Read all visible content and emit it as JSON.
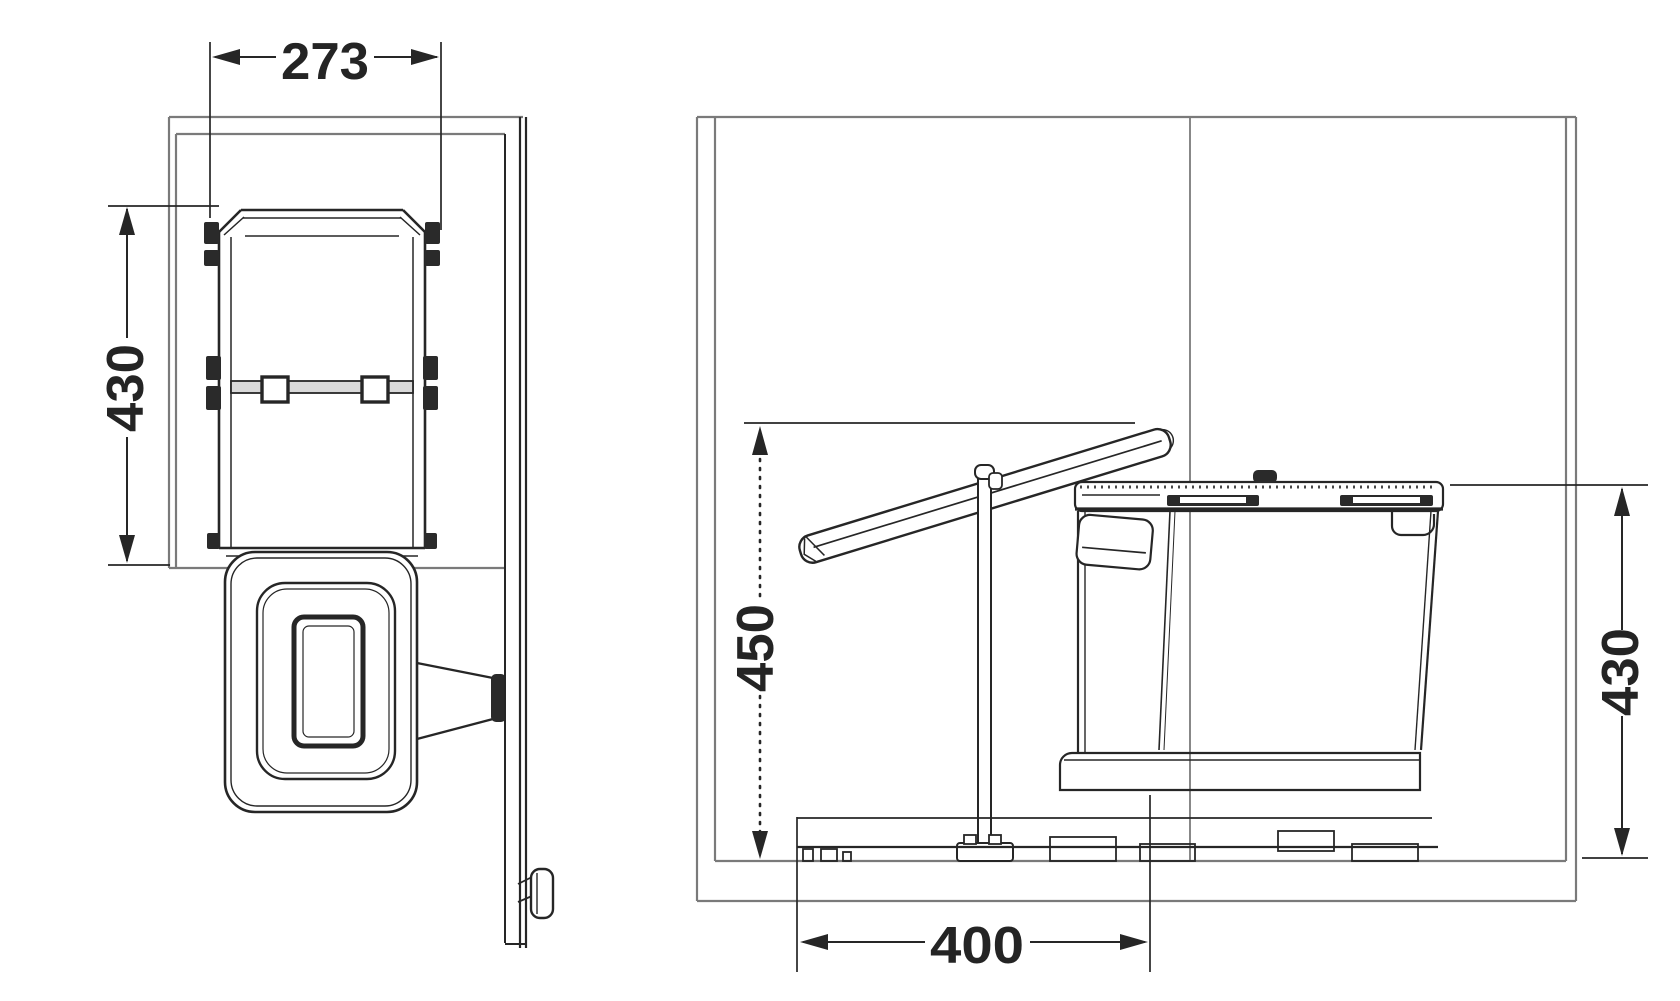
{
  "drawing_type": "installation-dimension-drawing",
  "colors": {
    "background": "#ffffff",
    "ink": "#262626",
    "cabinet_line": "#7a7a7a",
    "band_fill": "#d9d9d9"
  },
  "dimensions": {
    "plan_width": {
      "value": "273",
      "orientation": "horizontal"
    },
    "plan_depth": {
      "value": "430",
      "orientation": "vertical"
    },
    "side_open_lid_height": {
      "value": "450",
      "orientation": "vertical"
    },
    "side_bin_height": {
      "value": "430",
      "orientation": "vertical"
    },
    "side_pullout_depth": {
      "value": "400",
      "orientation": "horizontal"
    }
  }
}
